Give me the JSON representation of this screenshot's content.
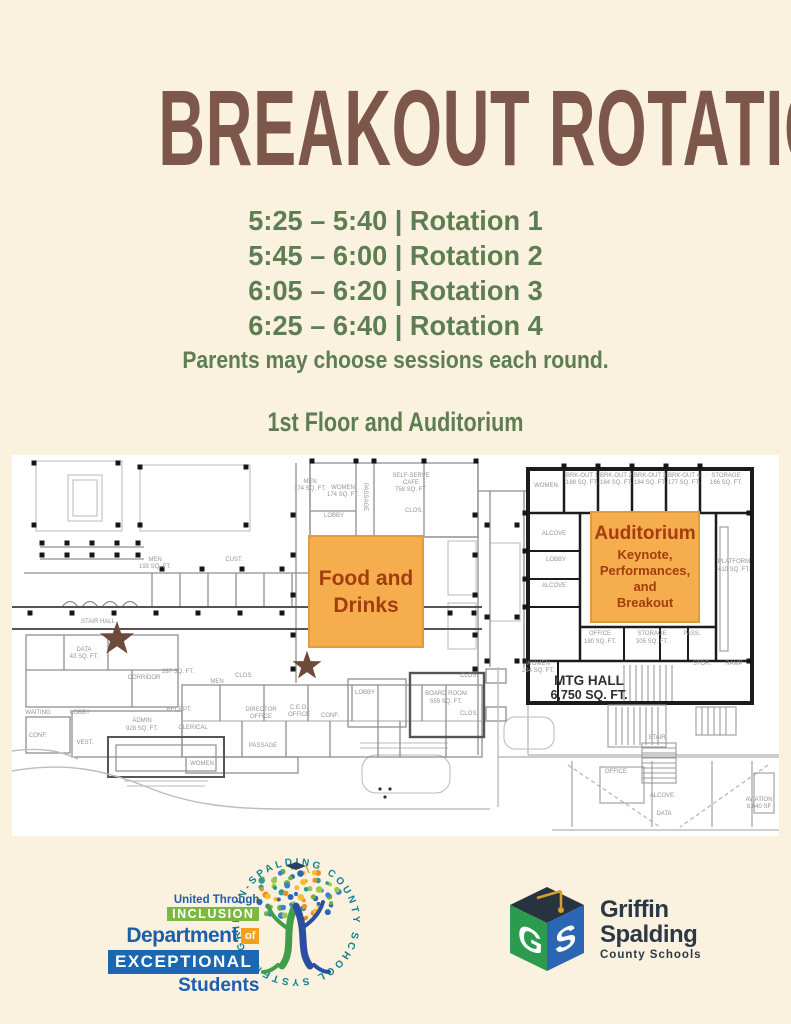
{
  "title": "BREAKOUT ROTATIONS",
  "schedule": {
    "rotations": [
      "5:25 – 5:40 | Rotation 1",
      "5:45 – 6:00 | Rotation 2",
      "6:05 – 6:20 | Rotation 3",
      "6:25 – 6:40 | Rotation 4"
    ],
    "note": "Parents may choose sessions each round."
  },
  "map_heading": "1st Floor and Auditorium",
  "colors": {
    "background": "#fbf1df",
    "title_brown": "#7d574a",
    "schedule_green": "#5d7e52",
    "highlight_orange": "#f6ad4e",
    "highlight_text": "#a53c0e",
    "star_brown": "#6d4a39"
  },
  "floor_plan": {
    "food": {
      "lines": [
        "Food and",
        "Drinks"
      ]
    },
    "auditorium": {
      "title": "Auditorium",
      "lines": [
        "Keynote,",
        "Performances,",
        "and",
        "Breakout"
      ]
    },
    "mtg_hall": {
      "name": "MTG HALL",
      "area": "6,750 SQ. FT."
    },
    "star_marker_count": 2,
    "room_labels": [
      {
        "t": "MEN",
        "x": 143,
        "y": 106
      },
      {
        "t": "193 SQ. FT.",
        "x": 143,
        "y": 113
      },
      {
        "t": "CUST.",
        "x": 222,
        "y": 106
      },
      {
        "t": "STAIR HALL",
        "x": 86,
        "y": 168
      },
      {
        "t": "DATA",
        "x": 72,
        "y": 196
      },
      {
        "t": "43 SQ. FT.",
        "x": 72,
        "y": 203
      },
      {
        "t": "CORRIDOR",
        "x": 132,
        "y": 224
      },
      {
        "t": "287 SQ. FT.",
        "x": 166,
        "y": 218
      },
      {
        "t": "LOBBY",
        "x": 68,
        "y": 259
      },
      {
        "t": "ADMIN",
        "x": 130,
        "y": 267
      },
      {
        "t": "928 SQ. FT.",
        "x": 130,
        "y": 275
      },
      {
        "t": "VEST.",
        "x": 73,
        "y": 289
      },
      {
        "t": "WAITING",
        "x": 26,
        "y": 259
      },
      {
        "t": "CONF.",
        "x": 26,
        "y": 282
      },
      {
        "t": "RECEPT.",
        "x": 167,
        "y": 256
      },
      {
        "t": "CLERICAL",
        "x": 181,
        "y": 274
      },
      {
        "t": "WOMEN",
        "x": 190,
        "y": 310
      },
      {
        "t": "MEN",
        "x": 205,
        "y": 228
      },
      {
        "t": "CLOS.",
        "x": 232,
        "y": 222
      },
      {
        "t": "DIRECTOR",
        "x": 249,
        "y": 256
      },
      {
        "t": "OFFICE",
        "x": 249,
        "y": 263
      },
      {
        "t": "C.E.O.",
        "x": 287,
        "y": 254
      },
      {
        "t": "OFFICE",
        "x": 287,
        "y": 261
      },
      {
        "t": "CONF.",
        "x": 318,
        "y": 262
      },
      {
        "t": "PASSAGE",
        "x": 251,
        "y": 292
      },
      {
        "t": "MEN",
        "x": 298,
        "y": 28
      },
      {
        "t": "174 SQ. FT.",
        "x": 298,
        "y": 35
      },
      {
        "t": "WOMEN",
        "x": 331,
        "y": 34
      },
      {
        "t": "174 SQ. FT.",
        "x": 331,
        "y": 41
      },
      {
        "t": "PASSAGE",
        "x": 352,
        "y": 42,
        "r": 90
      },
      {
        "t": "SELF-SERVE",
        "x": 399,
        "y": 22
      },
      {
        "t": "CAFE",
        "x": 399,
        "y": 29
      },
      {
        "t": "758 SQ. FT.",
        "x": 399,
        "y": 36
      },
      {
        "t": "CLOS.",
        "x": 402,
        "y": 57
      },
      {
        "t": "LOBBY",
        "x": 322,
        "y": 62
      },
      {
        "t": "LOBBY",
        "x": 353,
        "y": 239
      },
      {
        "t": "BOARD ROOM",
        "x": 434,
        "y": 240
      },
      {
        "t": "559 SQ. FT.",
        "x": 434,
        "y": 248
      },
      {
        "t": "CLOS.",
        "x": 457,
        "y": 222
      },
      {
        "t": "CLOS.",
        "x": 457,
        "y": 260
      },
      {
        "t": "WOMEN",
        "x": 534,
        "y": 32
      },
      {
        "t": "BRK-OUT 1",
        "x": 570,
        "y": 22
      },
      {
        "t": "188 SQ. FT.",
        "x": 570,
        "y": 29
      },
      {
        "t": "BRK-OUT 2",
        "x": 604,
        "y": 22
      },
      {
        "t": "184 SQ. FT.",
        "x": 604,
        "y": 29
      },
      {
        "t": "BRK-OUT 3",
        "x": 638,
        "y": 22
      },
      {
        "t": "184 SQ. FT.",
        "x": 638,
        "y": 29
      },
      {
        "t": "BRK-OUT 4",
        "x": 672,
        "y": 22
      },
      {
        "t": "177 SQ. FT.",
        "x": 672,
        "y": 29
      },
      {
        "t": "STORAGE",
        "x": 714,
        "y": 22
      },
      {
        "t": "166 SQ. FT.",
        "x": 714,
        "y": 29
      },
      {
        "t": "ALCOVE",
        "x": 542,
        "y": 80
      },
      {
        "t": "LOBBY",
        "x": 544,
        "y": 106
      },
      {
        "t": "ALCOVE",
        "x": 542,
        "y": 132
      },
      {
        "t": "PLATFORM",
        "x": 722,
        "y": 108
      },
      {
        "t": "410 SQ. FT.",
        "x": 722,
        "y": 116
      },
      {
        "t": "OFFICE",
        "x": 588,
        "y": 180
      },
      {
        "t": "180 SQ. FT.",
        "x": 588,
        "y": 188
      },
      {
        "t": "STORAGE",
        "x": 640,
        "y": 180
      },
      {
        "t": "305 SQ. FT.",
        "x": 640,
        "y": 188
      },
      {
        "t": "PASS.",
        "x": 680,
        "y": 180
      },
      {
        "t": "WOMEN",
        "x": 526,
        "y": 210
      },
      {
        "t": "234 SQ. FT.",
        "x": 526,
        "y": 217
      },
      {
        "t": "STOR.",
        "x": 690,
        "y": 210
      },
      {
        "t": "RAMP",
        "x": 722,
        "y": 210
      },
      {
        "t": "STAIR",
        "x": 645,
        "y": 284
      },
      {
        "t": "OFFICE",
        "x": 604,
        "y": 318
      },
      {
        "t": "ALCOVE",
        "x": 650,
        "y": 342
      },
      {
        "t": "DATA",
        "x": 652,
        "y": 360
      },
      {
        "t": "AVIATION",
        "x": 747,
        "y": 346
      },
      {
        "t": "8,640 SF",
        "x": 747,
        "y": 353
      }
    ]
  },
  "logos": {
    "inclusion": {
      "united": "United Through",
      "inclusion": "INCLUSION",
      "department": "Department",
      "of": "of",
      "exceptional": "EXCEPTIONAL",
      "students": "Students",
      "ring_text": "GRIFFIN-SPALDING COUNTY SCHOOL SYSTEM"
    },
    "district": {
      "name1": "Griffin",
      "name2": "Spalding",
      "name3": "County Schools",
      "cube_letters": "GS"
    }
  }
}
